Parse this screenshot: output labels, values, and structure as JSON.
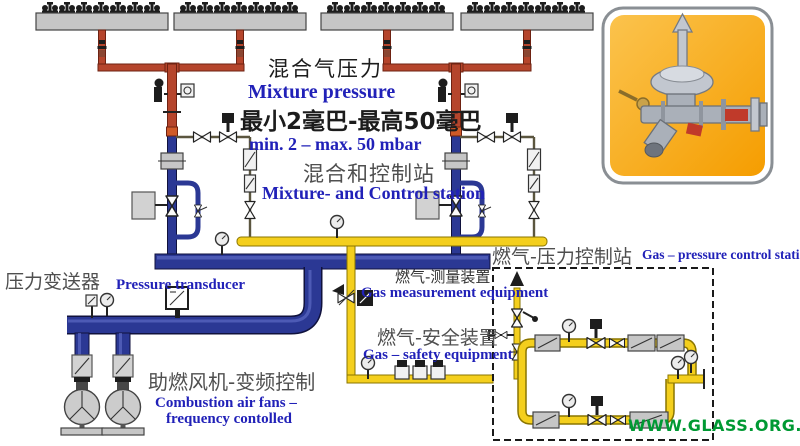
{
  "labels": {
    "mixture_pressure_zh": "混合气压力",
    "mixture_pressure_en": "Mixture pressure",
    "pressure_range_zh": "最小2毫巴-最高50毫巴",
    "pressure_range_en": "min. 2 – max. 50 mbar",
    "control_station_zh": "混合和控制站",
    "control_station_en": "Mixture- and Control station",
    "gas_station_zh": "燃气-压力控制站",
    "gas_station_en": "Gas – pressure control station",
    "transducer_zh": "压力变送器",
    "transducer_en": "Pressure transducer",
    "measurement_zh": "燃气-测量装置",
    "measurement_en": "Gas measurement equipment",
    "safety_zh": "燃气-安全装置",
    "safety_en": "Gas –  safety equipment",
    "fans_zh": "助燃风机-变频控制",
    "fans_en_line1": "Combustion air fans –",
    "fans_en_line2": "frequency contolled",
    "watermark": "WWW.GLASS.ORG.CN"
  },
  "diagram": {
    "manifold_count": 4,
    "burners_per_manifold": 7,
    "mixture_train_count": 2,
    "fan_count": 2,
    "pressure_range": {
      "min_mbar": 2,
      "max_mbar": 50
    },
    "legend": {
      "red_pipe": "gas-air mixture to burners",
      "blue_pipe": "combustion air",
      "yellow_pipe": "fuel gas"
    }
  },
  "colors": {
    "mixture-red": "#b5452c",
    "mixture-red-dark": "#6e2212",
    "air-navy": "#2b3894",
    "air-navy-dark": "#10123d",
    "gas-yellow": "#f4cf1d",
    "gas-yellow-dark": "#8a7500",
    "collar-orange": "#cf5a28",
    "label-blue": "#2121b8",
    "label-gray": "#4f4f4f",
    "watermark-green": "#009933",
    "photo-orange-1": "#fbc34d",
    "photo-orange-2": "#f59d00"
  }
}
